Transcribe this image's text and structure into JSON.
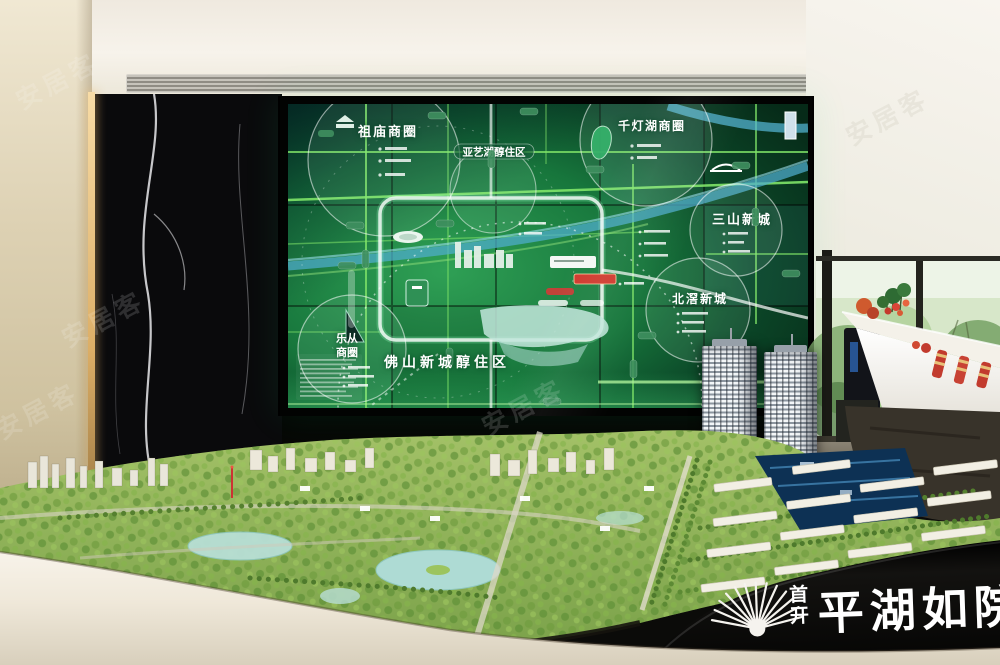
{
  "scene": {
    "description": "Real-estate sales gallery: LED master-plan wall above a physical city scale model"
  },
  "watermark": {
    "text": "安居客"
  },
  "led_screen": {
    "districts": {
      "zumiao": "祖庙商圈",
      "qiandenghu": "千灯湖商圈",
      "sanshan": "三山新城",
      "beijiao": "北滘新城",
      "lecong_line1": "乐从",
      "lecong_line2": "商圈",
      "yayihu": "亚艺湖醇住区",
      "foshan_new_town": "佛山新城醇住区"
    },
    "colors": {
      "screen_green": "#17763c",
      "neon_road_green": "#7fe468",
      "river_blue": "#4fadce",
      "project_highlight_red": "#d03a2f"
    }
  },
  "model": {
    "logo": {
      "brand_char1": "首",
      "brand_char2": "开",
      "project_name": "平湖如院"
    }
  }
}
